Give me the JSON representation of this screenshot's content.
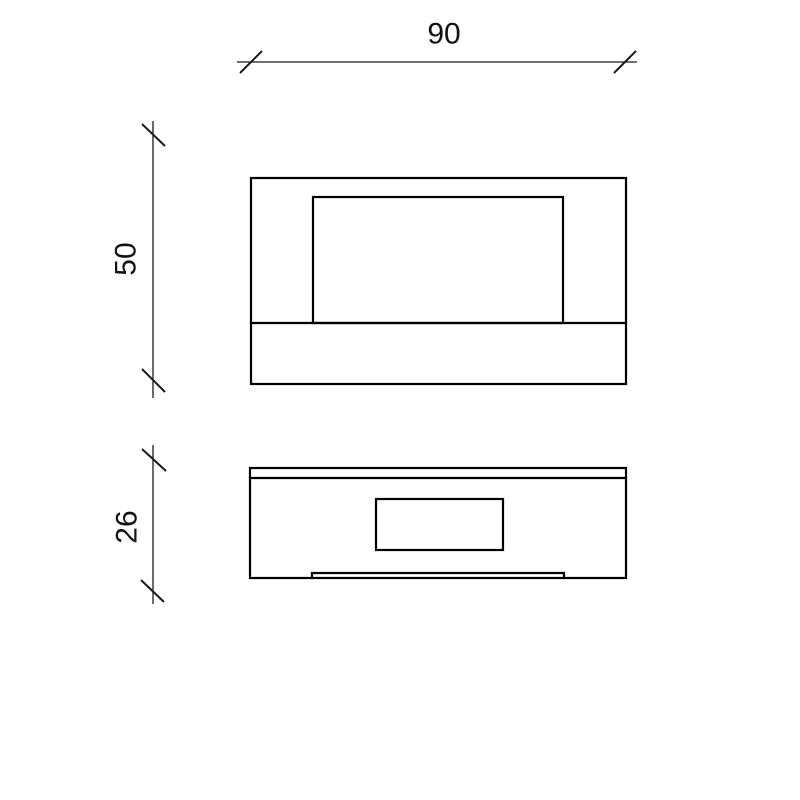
{
  "drawing": {
    "background_color": "#ffffff",
    "object_line_color": "#000000",
    "dimension_line_color": "#1a1a1a",
    "dimensions": {
      "width": {
        "label": "90",
        "orientation": "horizontal"
      },
      "height": {
        "label": "50",
        "orientation": "vertical"
      },
      "depth": {
        "label": "26",
        "orientation": "vertical"
      }
    },
    "views": {
      "front_view": {
        "description": "front elevation with inner panel and base band"
      },
      "bottom_view": {
        "description": "bottom view with top lip, center cutout and mounting tab"
      }
    }
  }
}
